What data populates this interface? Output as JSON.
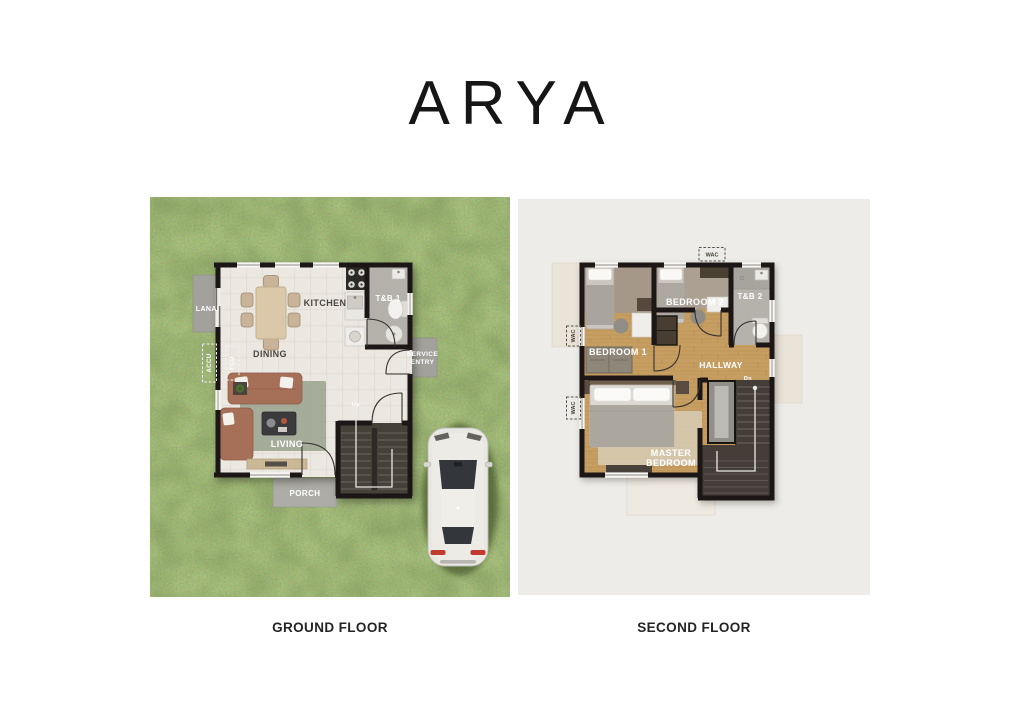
{
  "title": "ARYA",
  "ground_floor": {
    "caption": "GROUND FLOOR",
    "rooms": {
      "lanai": "LANAI",
      "kitchen": "KITCHEN",
      "toilet_bath_1": "T&B 1",
      "dining": "DINING",
      "living": "LIVING",
      "porch": "PORCH"
    },
    "annotations": {
      "accu": "ACCU",
      "fcu": "FCU",
      "service_line1": "SERVICE",
      "service_line2": "ENTRY",
      "stairs_up": "Up"
    }
  },
  "second_floor": {
    "caption": "SECOND FLOOR",
    "rooms": {
      "bedroom_1": "BEDROOM 1",
      "bedroom_2": "BEDROOM 2",
      "toilet_bath_2": "T&B 2",
      "hallway": "HALLWAY",
      "master_line1": "MASTER",
      "master_line2": "BEDROOM"
    },
    "annotations": {
      "wac_top": "WAC",
      "wac_left_upper": "WAC",
      "wac_left_lower": "WAC",
      "stairs_down": "Dn"
    }
  },
  "colors": {
    "grass": "#5e7a33",
    "panel_bg": "#edece8",
    "wall": "#1b1814",
    "wood_floor": "#c79e62",
    "tile_floor": "#ebe7e1",
    "slab_gray": "#a2a19b",
    "stair_dark": "#453f39",
    "label_light": "#ffffff",
    "label_dark": "#4a4540",
    "heading_text": "#161616"
  }
}
